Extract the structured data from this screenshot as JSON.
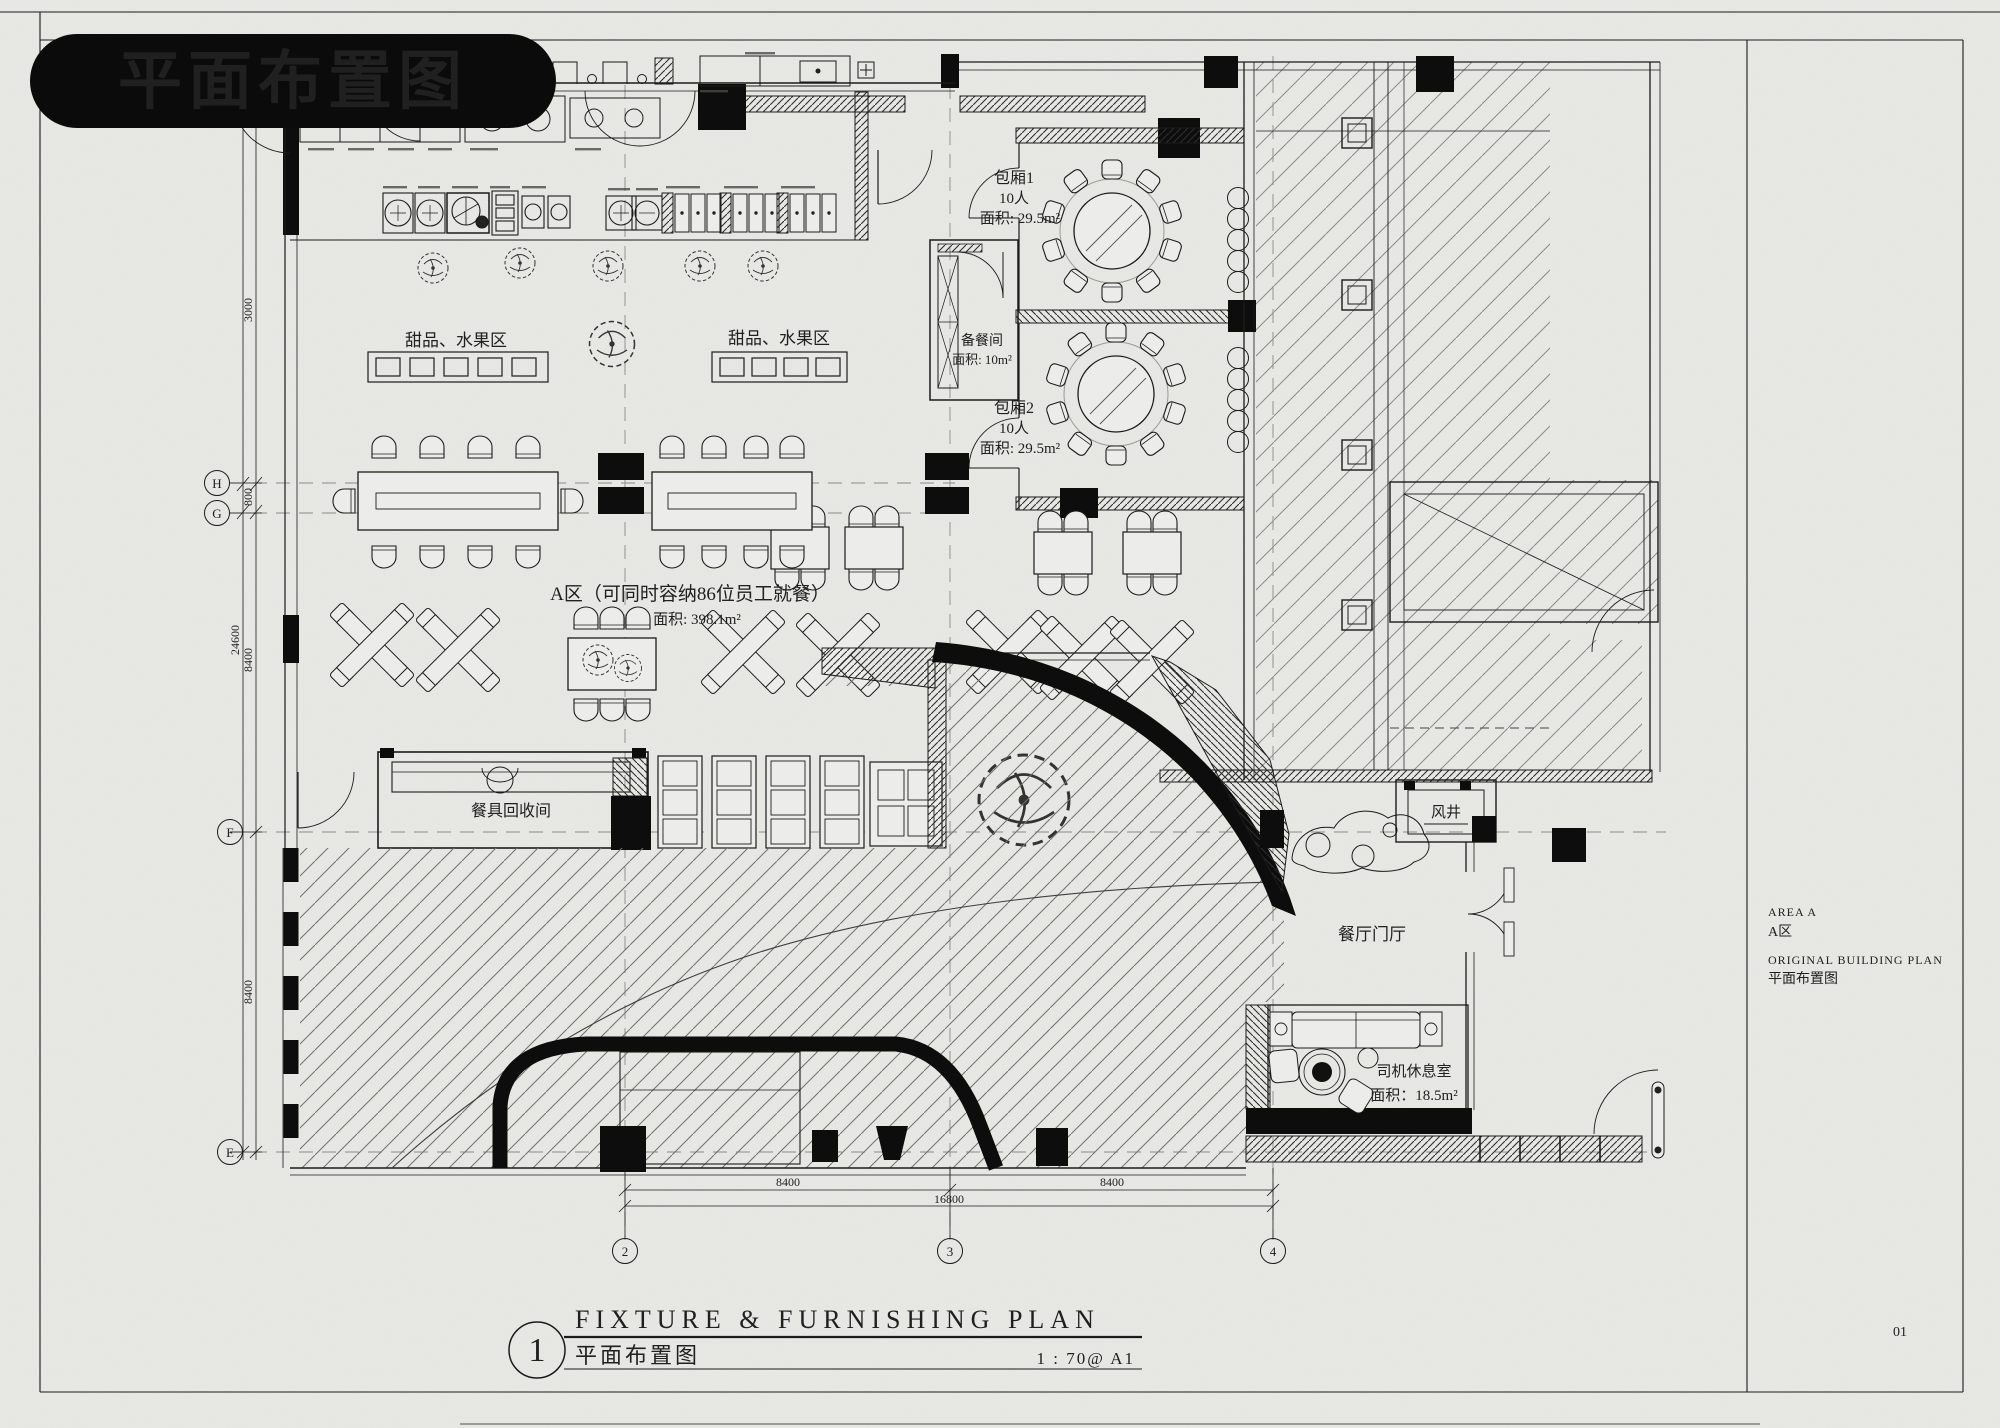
{
  "page": {
    "background": "#e9eae6",
    "ink": "#1b1b1b",
    "badge_bg": "#0b0b0b",
    "badge_text_color": "#ffffff",
    "page_number": "01"
  },
  "badge": {
    "title": "平面布置图"
  },
  "plan": {
    "zone_a": {
      "line1": "A区（可同时容纳86位员工就餐）",
      "line2": "面积: 398.1m²"
    },
    "room1": {
      "name": "包厢1",
      "capacity": "10人",
      "area": "面积: 29.5m²"
    },
    "room2": {
      "name": "包厢2",
      "capacity": "10人",
      "area": "面积: 29.5m²"
    },
    "prep_room": {
      "name": "备餐间",
      "area": "面积: 10m²"
    },
    "dessert_area": "甜品、水果区",
    "dish_return_room": "餐具回收间",
    "air_shaft": "风井",
    "foyer": "餐厅门厅",
    "driver_room": {
      "name": "司机休息室",
      "area": "面积：18.5m²"
    }
  },
  "dimensions": {
    "left": {
      "overall": "24600",
      "segments": [
        "3000",
        "800",
        "8400",
        "8400"
      ]
    },
    "bottom": {
      "overall": "16800",
      "segments": [
        "8400",
        "8400"
      ]
    }
  },
  "axes": {
    "left": [
      "H",
      "G",
      "F",
      "E"
    ],
    "bottom": [
      "2",
      "3",
      "4"
    ]
  },
  "title_block": {
    "number": "1",
    "title_en": "FIXTURE & FURNISHING PLAN",
    "title_cn": "平面布置图",
    "scale": "1 : 70@ A1"
  },
  "side_notes": {
    "area_en": "AREA A",
    "area_cn": "A区",
    "plan_en": "ORIGINAL BUILDING PLAN",
    "plan_cn": "平面布置图"
  }
}
